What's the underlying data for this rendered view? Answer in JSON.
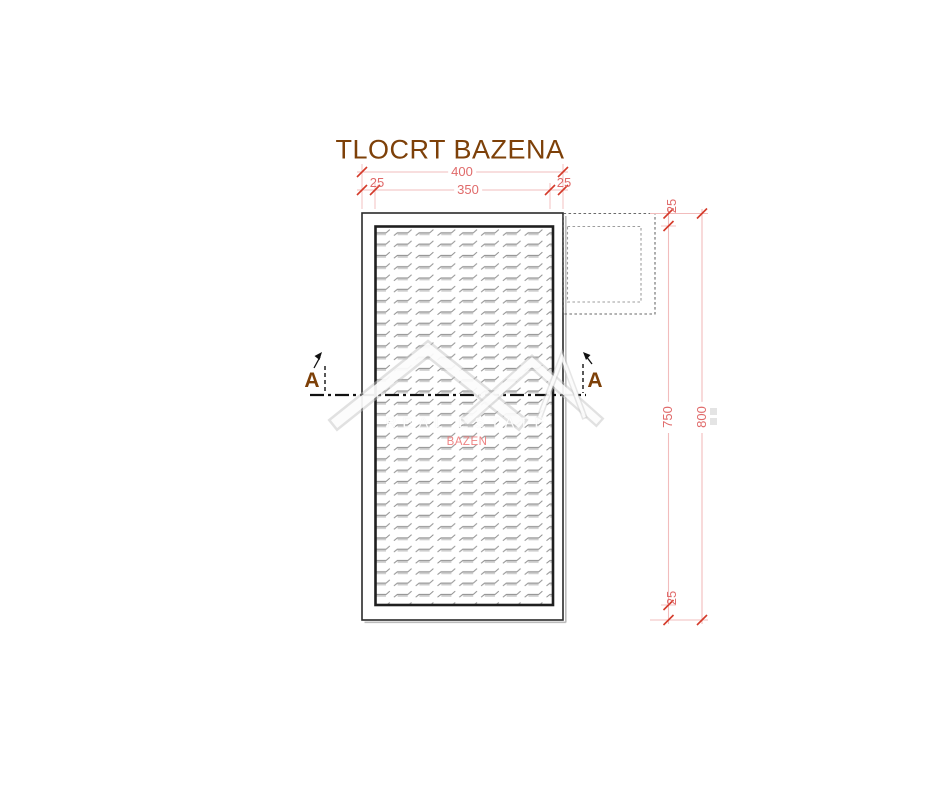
{
  "title": "TLOCRT BAZENA",
  "pool_label": "BAZEN",
  "section": {
    "left_label": "A",
    "right_label": "A"
  },
  "dimensions": {
    "top_total": "400",
    "top_left_wall": "25",
    "top_inner_width": "350",
    "top_right_wall": "25",
    "right_top_wall": "25",
    "right_inner_height": "750",
    "right_total_height": "800",
    "right_bottom_wall": "25"
  },
  "watermark": {
    "text": "REAL ESTATE"
  },
  "colors": {
    "title_brown": "#7d4008",
    "dimension_line_pink": "#f2bcbc",
    "dimension_text_red": "#e06a6a",
    "tick_red": "#d43a2a",
    "pool_outline_black": "#1f1f1f",
    "hatch_gray": "#8f8f8f",
    "pool_label_pink": "#ee8484",
    "dashed_box_gray": "#6a6a6a"
  }
}
